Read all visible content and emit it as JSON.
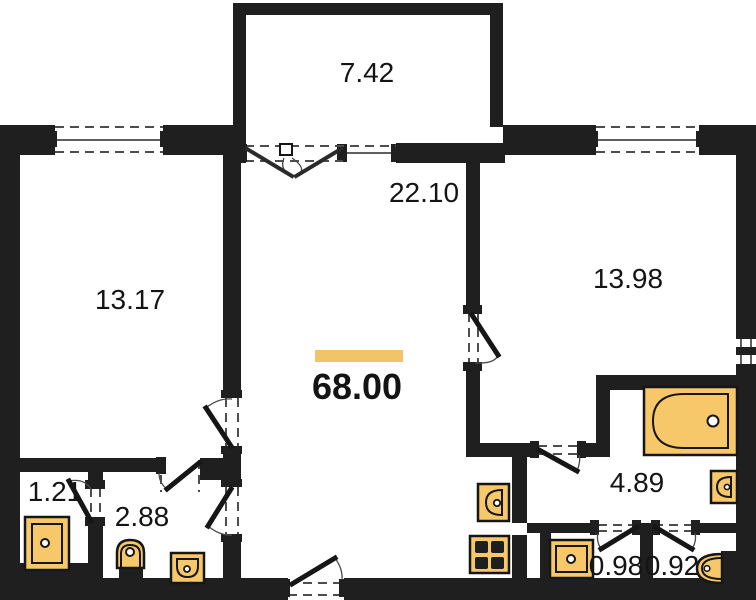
{
  "plan": {
    "total_area": {
      "value": "68.00"
    },
    "rooms": [
      {
        "id": "balcony",
        "area": "7.42"
      },
      {
        "id": "living-room",
        "area": "22.10"
      },
      {
        "id": "bedroom-left",
        "area": "13.17"
      },
      {
        "id": "bedroom-right",
        "area": "13.98"
      },
      {
        "id": "closet",
        "area": "1.21"
      },
      {
        "id": "toilet-room",
        "area": "2.88"
      },
      {
        "id": "bathroom-hall",
        "area": "4.89"
      },
      {
        "id": "wc-left",
        "area": "0.98"
      },
      {
        "id": "wc-right",
        "area": "0.92"
      }
    ],
    "fixtures": [
      "shower-tray",
      "toilet",
      "wash-basin",
      "kitchen-sink",
      "stove",
      "bathtub"
    ],
    "colors": {
      "wall": "#1f1f1f",
      "fixture": "#F7C869",
      "accent_bar": "#F2C46A",
      "background": "#ffffff"
    }
  }
}
